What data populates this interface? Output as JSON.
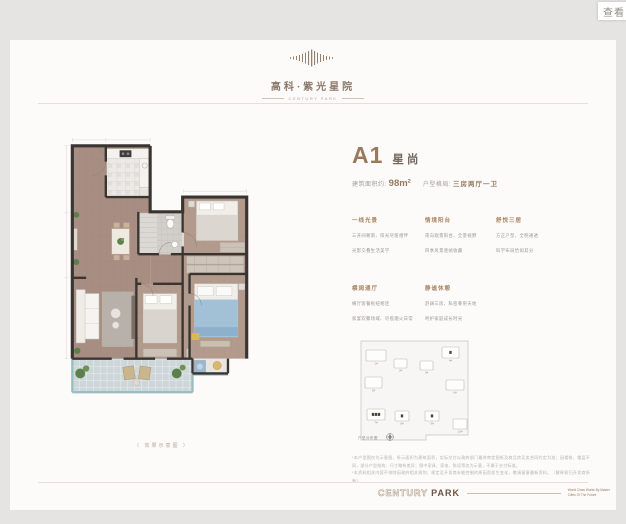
{
  "tooltip": {
    "label": "查看"
  },
  "brand": {
    "name_cn": "高科·紫光星院",
    "name_en": "CENTURY PARK"
  },
  "unit": {
    "code": "A1",
    "name": "星尚",
    "area_label": "建筑面积约:",
    "area_value": "98m²",
    "layout_label": "户型格局:",
    "layout_value": "三房两厅一卫",
    "features": [
      {
        "title": "一线光景",
        "lines": [
          "三开间朝南、阳光尽揽相伴",
          "光影交叠生活美学"
        ]
      },
      {
        "title": "情境阳台",
        "lines": [
          "南向观景阳台、全景视野",
          "四季风景逐帧收藏"
        ]
      },
      {
        "title": "舒悦三居",
        "lines": [
          "方正户型、全明通透",
          "科学布局恰如其分"
        ]
      },
      {
        "title": "横阔通厅",
        "lines": [
          "横厅客餐枢纽相连",
          "家宴欢聚场域、尽揽烟火日常"
        ]
      },
      {
        "title": "静谧休憩",
        "lines": [
          "舒阔三房、私密尊崇天地",
          "呵护家庭成长时光"
        ]
      }
    ]
  },
  "plan_caption": "（ 效果示意图 ）",
  "siteplan": {
    "caption": "户型分布图",
    "buildings": [
      {
        "label": "1#",
        "x": 12,
        "y": 14,
        "w": 20,
        "h": 11,
        "markers": 0
      },
      {
        "label": "2#",
        "x": 40,
        "y": 23,
        "w": 13,
        "h": 9,
        "markers": 0
      },
      {
        "label": "3#",
        "x": 66,
        "y": 25,
        "w": 13,
        "h": 9,
        "markers": 0
      },
      {
        "label": "4#",
        "x": 88,
        "y": 11,
        "w": 17,
        "h": 11,
        "markers": 1
      },
      {
        "label": "5#",
        "x": 11,
        "y": 41,
        "w": 17,
        "h": 11,
        "markers": 0
      },
      {
        "label": "6#",
        "x": 92,
        "y": 44,
        "w": 18,
        "h": 10,
        "markers": 0
      },
      {
        "label": "7#",
        "x": 13,
        "y": 73,
        "w": 18,
        "h": 11,
        "markers": 3
      },
      {
        "label": "8#",
        "x": 41,
        "y": 75,
        "w": 14,
        "h": 10,
        "markers": 1
      },
      {
        "label": "9#",
        "x": 71,
        "y": 75,
        "w": 14,
        "h": 10,
        "markers": 1
      },
      {
        "label": "10#",
        "x": 99,
        "y": 83,
        "w": 14,
        "h": 10,
        "markers": 0
      }
    ]
  },
  "disclaimer": {
    "line1": "*本户型图仅为示意图，所示面积为建筑面积，实际交付以政府部门最终审定图纸及商品房买卖合同约定为准；因楼栋、楼层不同，部分户型结构、尺寸略有差异；图中家具、家电、陈设等仅为示意，不属于交付标准。",
    "line2": "*本资料相关内容不排除因政府相关规划、规定及开发商未能控制的原因而发生变化，敬请留意最新资料。（解释权归开发商所有）"
  },
  "footer": {
    "brand_outline": "CENTURY",
    "brand_solid": "PARK",
    "tagline_line1": "World Class Works By Master",
    "tagline_line2": "Cities Of The Future"
  },
  "colors": {
    "accent_brown": "#9a7a5e",
    "feature_title_brown": "#a8825f",
    "wall_dark": "#3a3531",
    "wood_floor": "#a88e82",
    "balcony_tile": "#cdd7d9",
    "window_teal": "#96c2c4",
    "bed_blue": "#a2c1d7",
    "accent_yellow": "#d8ba55",
    "page_bg": "#fcfbfa",
    "outer_bg": "#e5e4e2"
  }
}
